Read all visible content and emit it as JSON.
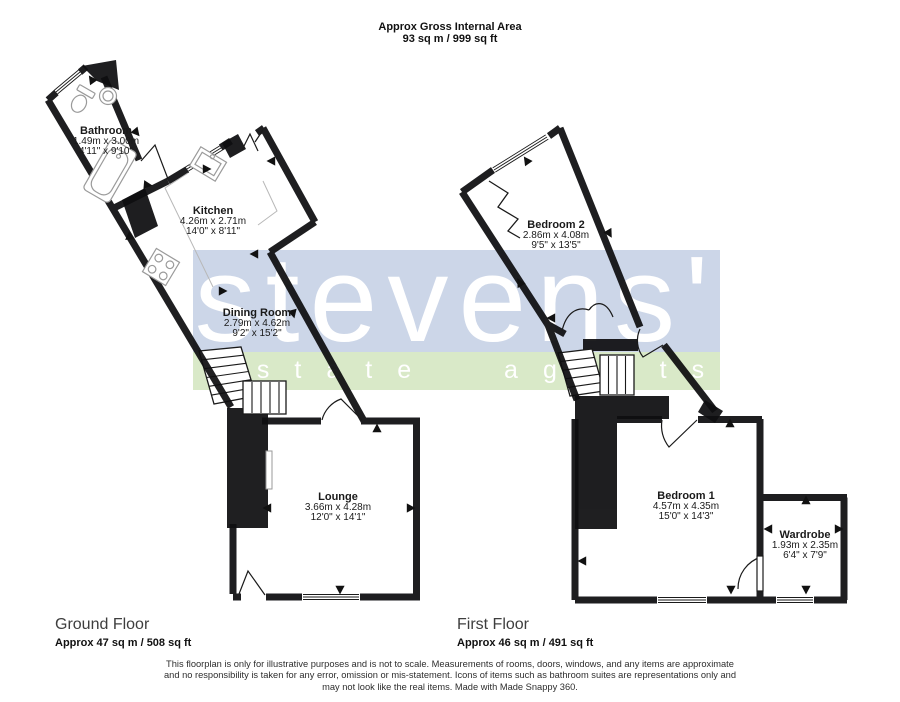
{
  "header": {
    "title": "Approx Gross Internal Area",
    "area": "93 sq m / 999 sq ft"
  },
  "watermark": {
    "brand": "stevens'",
    "tagline": "estate agents",
    "blue_band": "#ccd6e8",
    "green_band": "#d9e9c8",
    "text_color": "#ffffff"
  },
  "ground_floor": {
    "label": "Ground Floor",
    "area": "Approx 47 sq m / 508 sq ft",
    "rooms": {
      "bathroom": {
        "name": "Bathroom",
        "metric": "1.49m x 3.00m",
        "imperial": "4'11\" x 9'10\""
      },
      "kitchen": {
        "name": "Kitchen",
        "metric": "4.26m x 2.71m",
        "imperial": "14'0\" x 8'11\""
      },
      "dining_room": {
        "name": "Dining Room",
        "metric": "2.79m x 4.62m",
        "imperial": "9'2\" x 15'2\""
      },
      "lounge": {
        "name": "Lounge",
        "metric": "3.66m x 4.28m",
        "imperial": "12'0\" x 14'1\""
      }
    }
  },
  "first_floor": {
    "label": "First Floor",
    "area": "Approx 46 sq m / 491 sq ft",
    "rooms": {
      "bedroom2": {
        "name": "Bedroom 2",
        "metric": "2.86m x 4.08m",
        "imperial": "9'5\" x 13'5\""
      },
      "bedroom1": {
        "name": "Bedroom 1",
        "metric": "4.57m x 4.35m",
        "imperial": "15'0\" x 14'3\""
      },
      "wardrobe": {
        "name": "Wardrobe",
        "metric": "1.93m x 2.35m",
        "imperial": "6'4\" x 7'9\""
      }
    }
  },
  "footer": {
    "line1": "This floorplan is only for illustrative purposes and is not to scale. Measurements of rooms, doors, windows, and any items are approximate",
    "line2": "and no responsibility is taken for any error, omission or mis-statement. Icons of items such as bathroom suites are representations only and",
    "line3": "may not look like the real items. Made with Made Snappy 360."
  },
  "colors": {
    "wall": "#0e0e10"
  }
}
